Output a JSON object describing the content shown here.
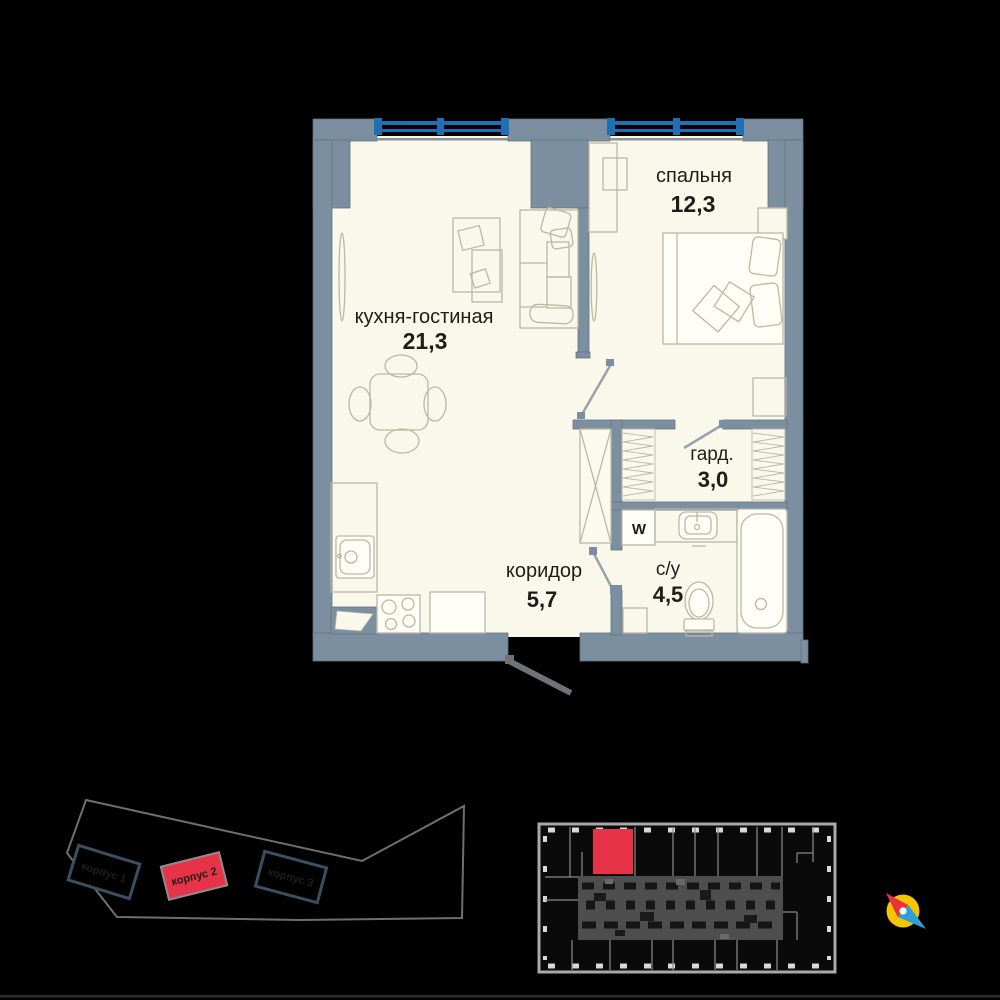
{
  "floor_plan": {
    "rooms": [
      {
        "name": "кухня-гостиная",
        "area": "21,3"
      },
      {
        "name": "спальня",
        "area": "12,3"
      },
      {
        "name": "гард.",
        "area": "3,0"
      },
      {
        "name": "коридор",
        "area": "5,7"
      },
      {
        "name": "с/у",
        "area": "4,5"
      }
    ],
    "appliance_labels": {
      "washer": "W"
    }
  },
  "site_plan": {
    "buildings": [
      {
        "label": "корпус 1",
        "highlighted": false
      },
      {
        "label": "корпус 2",
        "highlighted": true
      },
      {
        "label": "корпус 3",
        "highlighted": false
      }
    ]
  },
  "floor_schematic": {
    "highlighted_unit": "current apartment"
  },
  "colors": {
    "background": "#000000",
    "plan_floor": "#faf8ea",
    "walls": "#7b8fa0",
    "window_frame": "#1e6fb4",
    "furniture_line": "#bdb7a5",
    "text": "#1d1d1b",
    "accent_red": "#e73348",
    "outline_gray": "#6f6f6f",
    "compass_yellow": "#f6c500",
    "compass_blue": "#2d9fd8"
  }
}
